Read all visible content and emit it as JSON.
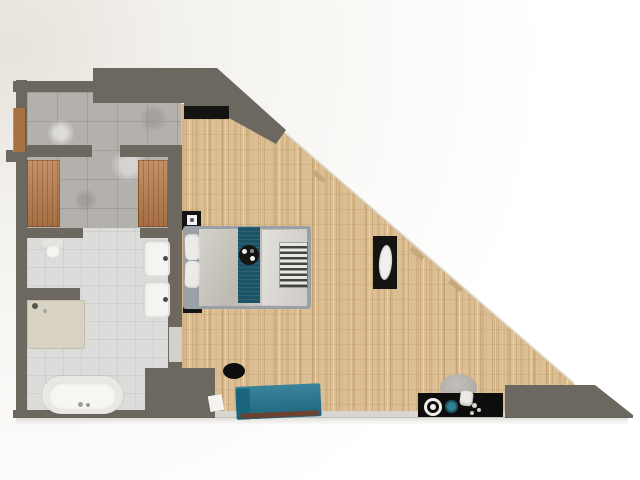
{
  "meta": {
    "kind": "3d-floorplan-render",
    "view": "top-down",
    "visible_text": "none"
  },
  "palette": {
    "wall": "#6c6860",
    "wall_edge_light": "#d9d6d1",
    "wood_floor": "#dcbf93",
    "marble_floor": "#b4b1ad",
    "tile_floor": "#dcdcda",
    "door_wood": "#a9713f",
    "wardrobe_wood": "#b87b4b",
    "bed_frame": "#99a1a7",
    "duvet": "#c7c3bc",
    "duvet_light": "#d6d3cd",
    "pillow": "#edebe7",
    "runner_teal": "#1d5366",
    "sofa_teal": "#20738e",
    "sofa_base": "#6d4030",
    "counter_black": "#0d0d0b",
    "furniture_black": "#141412",
    "fixture_white": "#f4f4f1",
    "shower_tray": "#d8d3c3",
    "stool_grey": "#b2afaa",
    "bowl_teal": "#2f8195",
    "glass_edge": "#cfc4ae"
  },
  "rooms": [
    {
      "name": "entry-hall",
      "floor": "marble-tile",
      "items": [
        "front-door"
      ]
    },
    {
      "name": "dressing-area",
      "floor": "marble-tile",
      "items": [
        "wardrobe-left",
        "wardrobe-right"
      ]
    },
    {
      "name": "bathroom",
      "floor": "white-tile",
      "items": [
        "toilet",
        "shower-tray",
        "double-vanity-sinks",
        "bathtub",
        "pocket-door"
      ]
    },
    {
      "name": "main-room",
      "floor": "oak-parquet",
      "items": [
        "tv",
        "nightstand-1",
        "nightstand-2",
        "double-bed",
        "bed-runner",
        "breakfast-tray",
        "foot-bench",
        "console-table",
        "pouf",
        "floor-mat",
        "sofa",
        "kitchen-counter",
        "stool",
        "plate",
        "bowl",
        "kettle"
      ]
    }
  ],
  "architecture": [
    "exterior-walls",
    "diagonal-glass-wall",
    "corner-wall-block",
    "bottom-right-wall-wedge"
  ]
}
